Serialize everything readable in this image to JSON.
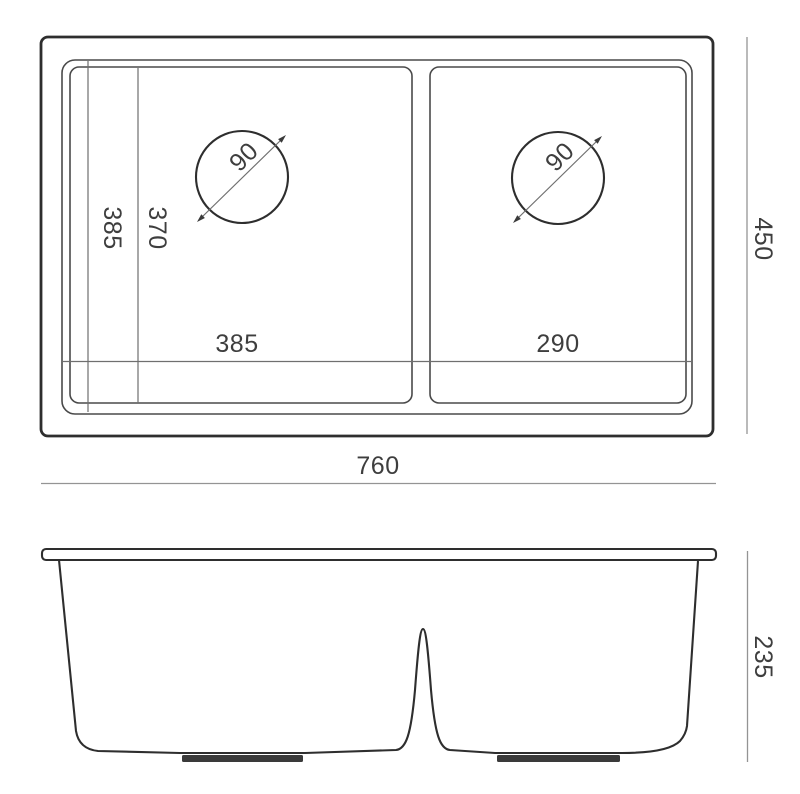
{
  "colors": {
    "line": "#2e2e2e",
    "mid_line": "#4a4a4a",
    "dim_line": "#949494",
    "text": "#3e3e3e",
    "background": "#ffffff"
  },
  "top_view": {
    "overall_width": "760",
    "overall_depth": "450",
    "left_bowl_width": "385",
    "right_bowl_width": "290",
    "bowl_depth_outer": "385",
    "bowl_depth_inner": "370",
    "left_drain_diameter": "90",
    "right_drain_diameter": "90"
  },
  "side_view": {
    "height": "235"
  }
}
